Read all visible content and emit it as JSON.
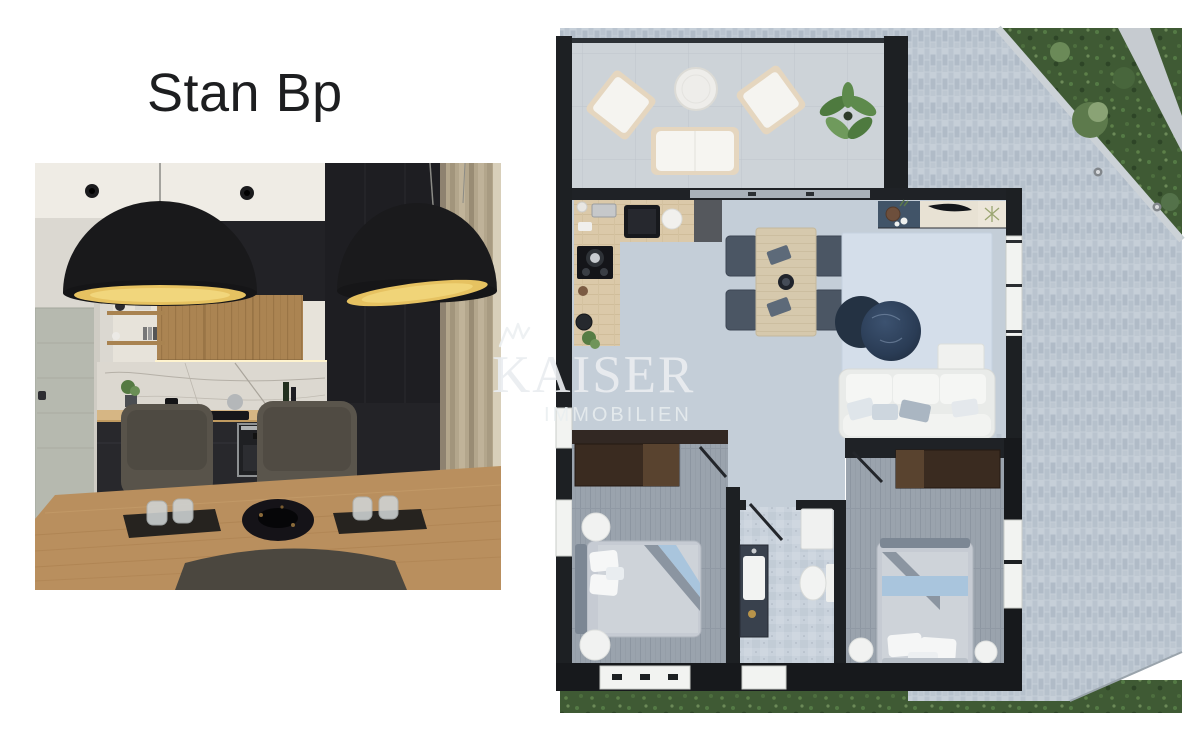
{
  "title": {
    "text": "Stan Bp"
  },
  "watermark": {
    "brand": "KAISER",
    "subtitle": "IMMOBILIEN",
    "icon": "crown",
    "color": "#e9edf0"
  },
  "icons": {
    "crown": "double-peak crown glyph drawn as zigzag strokes"
  },
  "photo": {
    "subject": "kitchen and dining room interior render"
  },
  "floor_plan": {
    "subject": "apartment floor plan top view with terrace, living-kitchen area, two bedrooms, bathroom, paved yard and lawn"
  },
  "colors": {
    "background": "#ffffff",
    "title_text": "#1d1e20",
    "plan_wall": "#1d2023",
    "plan_interior_floor": "#c4ced8",
    "plan_terrace_tile": "#cdd3d8",
    "plan_pavers": "#b9c3ce",
    "grass": "#3f5a34",
    "rug": "#d4deea",
    "kitchen_wood": "#dbc9a9",
    "bedroom_floor": "#9aa3ad",
    "wardrobe_wood": "#3a2b20",
    "sofa_white": "#e9ebe9",
    "pendant_glow": "#e6c261",
    "pendant_shell": "#19191b"
  }
}
